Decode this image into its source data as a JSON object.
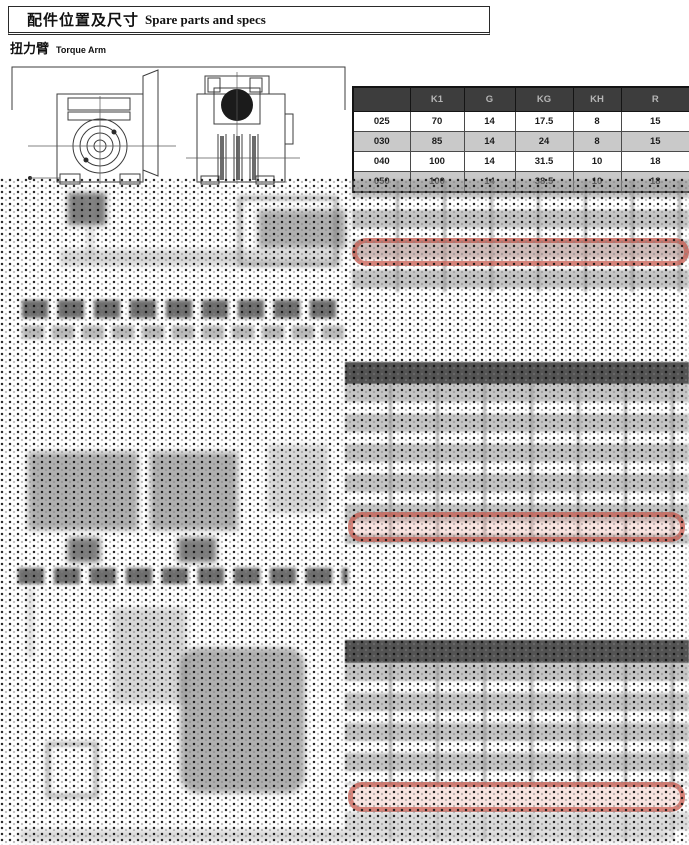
{
  "header": {
    "title_zh": "配件位置及尺寸",
    "title_en": "Spare parts and specs",
    "subtitle_zh": "扭力臂",
    "subtitle_en": "Torque Arm"
  },
  "spec_table": {
    "columns": [
      "",
      "K1",
      "G",
      "KG",
      "KH",
      "R"
    ],
    "rows": [
      [
        "025",
        "70",
        "14",
        "17.5",
        "8",
        "15"
      ],
      [
        "030",
        "85",
        "14",
        "24",
        "8",
        "15"
      ],
      [
        "040",
        "100",
        "14",
        "31.5",
        "10",
        "18"
      ],
      [
        "050",
        "100",
        "14",
        "38.5",
        "10",
        "18"
      ]
    ]
  },
  "colors": {
    "table_header_bg": "#3d3d3d",
    "table_header_text": "#b5b5b5",
    "row_alt_bg": "#c9c9c9",
    "highlight_red": "#c1493c"
  }
}
